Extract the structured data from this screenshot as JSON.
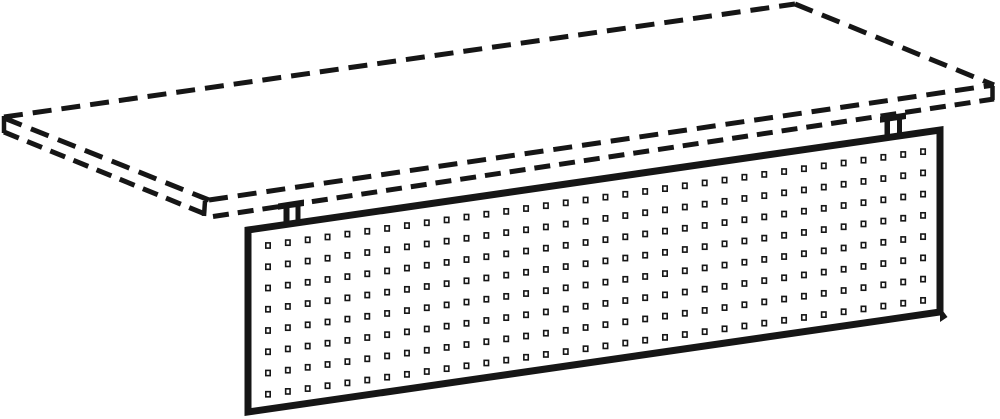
{
  "illustration": {
    "alt": "Technical line drawing of a perforated privacy / modesty panel hung by two brackets beneath a desk top; the desk top is drawn with dashed lines",
    "viewBox": "0 0 1000 419",
    "background": "#ffffff",
    "ink": "#161616",
    "desktop": {
      "stroke_width": 5,
      "dash": "19 10",
      "band_dash": "16 9",
      "edges": [
        {
          "name": "back-left",
          "x1": 4,
          "y1": 117,
          "x2": 795,
          "y2": 4
        },
        {
          "name": "back-right",
          "x1": 795,
          "y1": 4,
          "x2": 994,
          "y2": 85
        },
        {
          "name": "front-right",
          "x1": 209,
          "y1": 200,
          "x2": 994,
          "y2": 85
        },
        {
          "name": "front-left",
          "x1": 4,
          "y1": 118,
          "x2": 209,
          "y2": 200
        }
      ],
      "band_lines": [
        {
          "name": "front-left-thickness",
          "x1": 4,
          "y1": 132,
          "x2": 205,
          "y2": 214
        },
        {
          "name": "front-right-thickness",
          "x1": 213,
          "y1": 216.5,
          "x2": 994,
          "y2": 99
        }
      ],
      "corner_ticks": [
        {
          "name": "left-corner",
          "x1": 4,
          "y1": 116,
          "x2": 4,
          "y2": 133
        },
        {
          "name": "front-corner",
          "x1": 205,
          "y1": 201,
          "x2": 204,
          "y2": 216
        },
        {
          "name": "right-corner",
          "x1": 992.5,
          "y1": 86,
          "x2": 992.5,
          "y2": 100
        }
      ]
    },
    "brackets": [
      {
        "name": "mounting-bracket-left",
        "path": "M278,203.5 L304,199.5 L304,206 L300.5,206.5 L300.5,221.5 L295.5,222.2 L295.5,207.2 L289.5,208 L289.5,223 L283.5,223.8 L283.5,208.9 L278,209.7 Z"
      },
      {
        "name": "mounting-bracket-right",
        "path": "M880,116.5 L906,112.5 L906,119 L902,119.6 L902,134.6 L897,135.3 L897,120.3 L890,121.3 L890,136.2 L884.5,137 L884.5,122.1 L880,122.8 Z"
      }
    ],
    "panel": {
      "path": "M248,230 L940,130 L940,312 L248,412 Z",
      "fill": "#ffffff",
      "stroke_width": 7,
      "corner_nub_path": "M940,307 L947.5,317 L940,322 Z"
    },
    "holes": {
      "rows": 8,
      "cols": 34,
      "start_x": 268,
      "start_y": 245.5,
      "col_step": 19.85,
      "row_step": 21.25,
      "row_slope": -0.1433,
      "width": 4.4,
      "height": 5.2,
      "stroke_width": 1.6,
      "fill": "#ffffff"
    }
  }
}
